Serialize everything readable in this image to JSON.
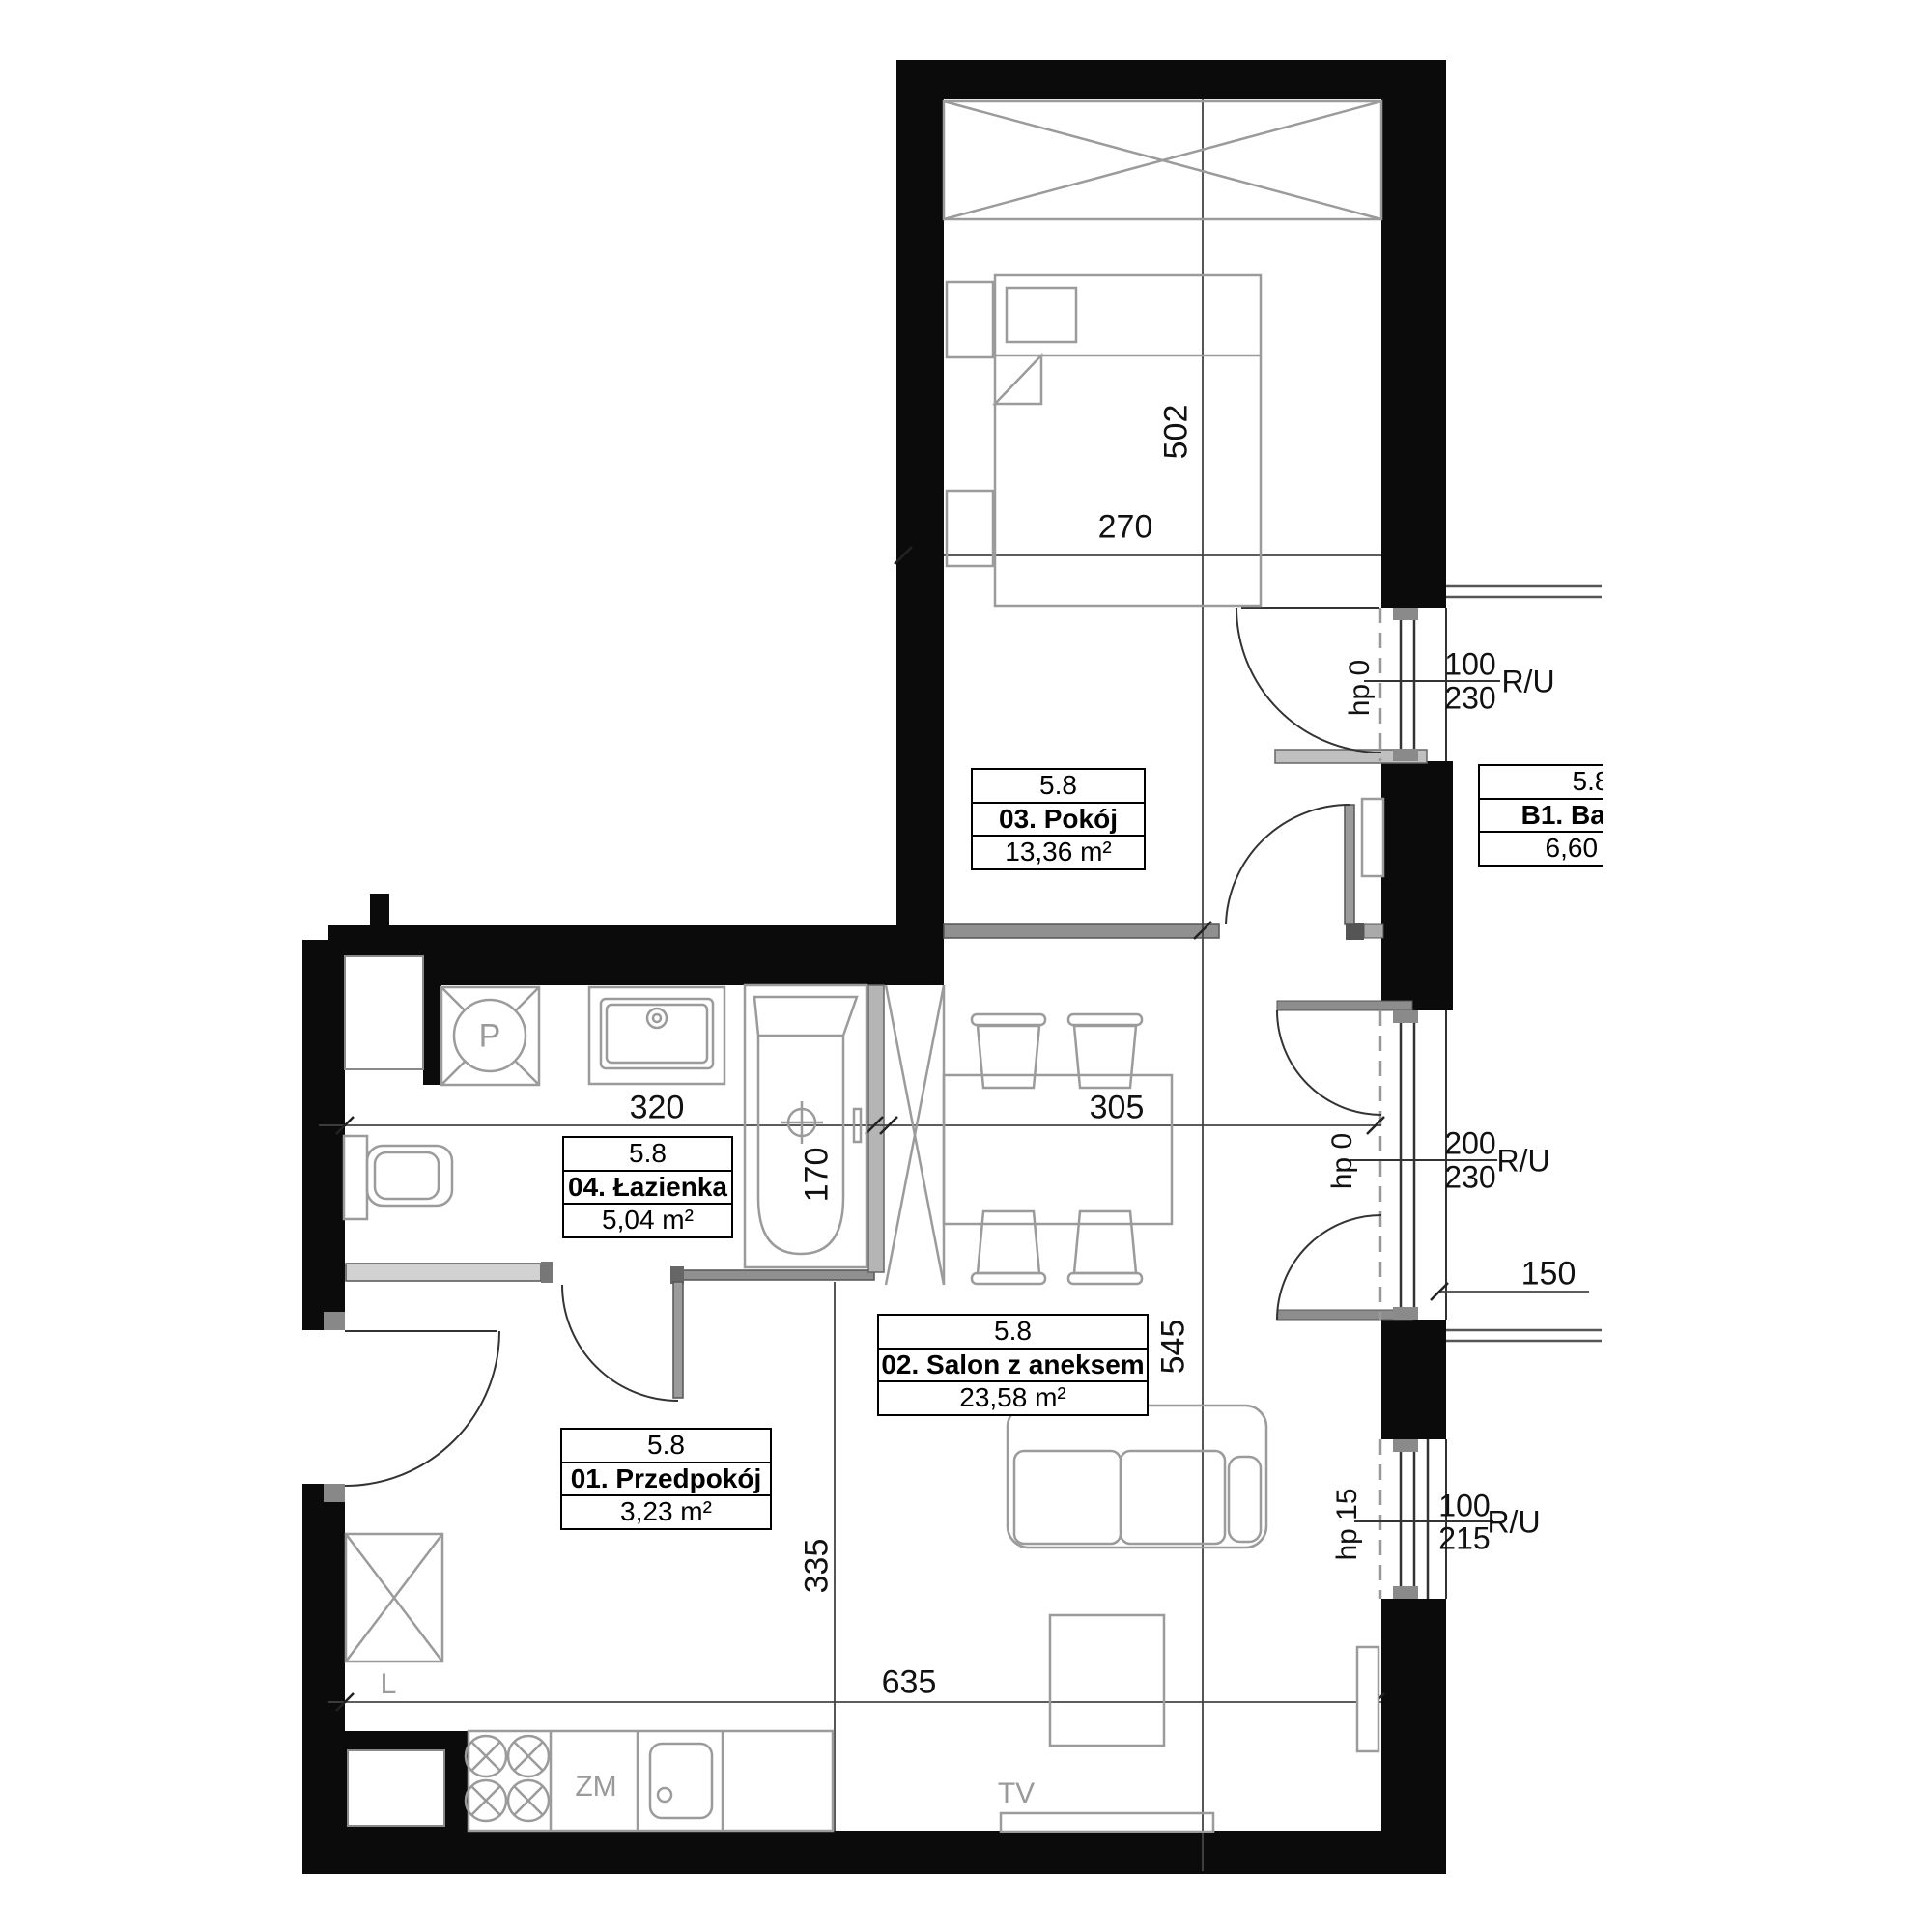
{
  "plan": {
    "rooms": [
      {
        "unit": "5.8",
        "name": "03. Pokój",
        "area": "13,36 m²"
      },
      {
        "unit": "5.8",
        "name": "04. Łazienka",
        "area": "5,04 m²"
      },
      {
        "unit": "5.8",
        "name": "02. Salon z aneksem",
        "area": "23,58 m²"
      },
      {
        "unit": "5.8",
        "name": "01. Przedpokój",
        "area": "3,23 m²"
      },
      {
        "unit": "5.8",
        "name": "B1. Balkon",
        "area": "6,60 m²"
      }
    ],
    "dims": {
      "bedroom_w": "270",
      "bedroom_h": "502",
      "bath_w": "320",
      "salon_w": "305",
      "tub_l": "170",
      "salon_h": "545",
      "hall_h": "335",
      "total_w": "635",
      "balcony_d": "150"
    },
    "windows": [
      {
        "sill": "hp 0",
        "w": "100",
        "h": "230",
        "code": "R/U"
      },
      {
        "sill": "hp 0",
        "w": "200",
        "h": "230",
        "code": "R/U"
      },
      {
        "sill": "hp 15",
        "w": "100",
        "h": "215",
        "code": "R/U"
      }
    ],
    "appliances": {
      "washer": "P",
      "fridge": "L",
      "dishwasher": "ZM",
      "tv": "TV"
    },
    "colors": {
      "wall": "#0b0b0b",
      "furniture": "#9b9b9b",
      "dimension": "#1a1a1a"
    }
  }
}
